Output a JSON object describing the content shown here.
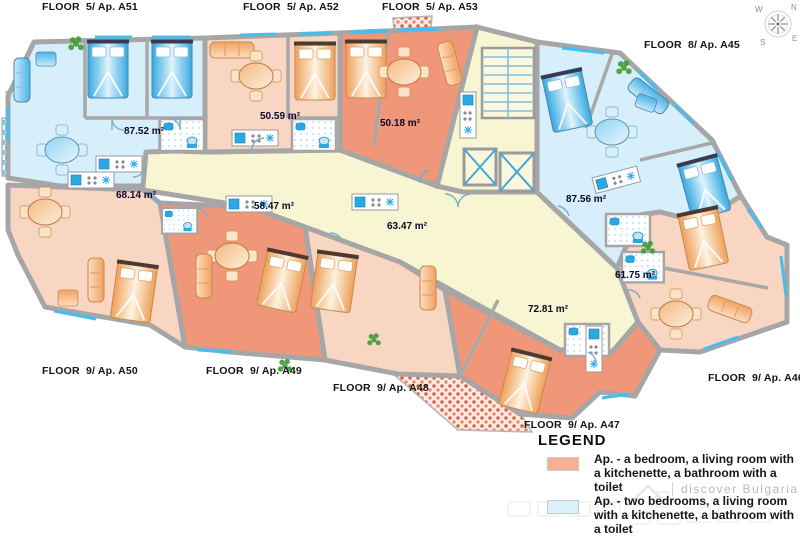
{
  "apartments": [
    {
      "name": "A51",
      "floor_label": "FLOOR  5/ Ap. A51",
      "area": "87.52 m²",
      "type": "two-bedroom"
    },
    {
      "name": "A52",
      "floor_label": "FLOOR  5/ Ap. A52",
      "area": "50.59 m²",
      "type": "one-bedroom"
    },
    {
      "name": "A53",
      "floor_label": "FLOOR  5/ Ap. A53",
      "area": "50.18 m²",
      "type": "one-bedroom"
    },
    {
      "name": "A45",
      "floor_label": "FLOOR  8/ Ap. A45",
      "area": "87.56 m²",
      "type": "two-bedroom"
    },
    {
      "name": "A50",
      "floor_label": "FLOOR  9/ Ap. A50",
      "area": "68.14 m²",
      "type": "one-bedroom"
    },
    {
      "name": "A49",
      "floor_label": "FLOOR  9/ Ap. A49",
      "area": "58.47 m²",
      "type": "one-bedroom"
    },
    {
      "name": "A48",
      "floor_label": "FLOOR  9/ Ap. A48",
      "area": "63.47 m²",
      "type": "one-bedroom"
    },
    {
      "name": "A47",
      "floor_label": "FLOOR  9/ Ap. A47",
      "area": "72.81 m²",
      "type": "one-bedroom"
    },
    {
      "name": "A46",
      "floor_label": "FLOOR  9/ Ap. A46",
      "area": "61.75 m²",
      "type": "one-bedroom"
    }
  ],
  "legend": {
    "title": "LEGEND",
    "items": [
      {
        "swatch_color": "#f6b094",
        "label": "Ap. - a bedroom, a living room with a kitchenette, a bathroom with a toilet"
      },
      {
        "swatch_color": "#d9f1fa",
        "label": "Ap. - two bedrooms, a living room with a kitchenette, a bathroom with a toilet"
      }
    ]
  },
  "compass": {
    "w": "W",
    "n": "N",
    "s": "S",
    "e": "E"
  },
  "watermark": "discover Bulgaria",
  "colors": {
    "one_bedroom_light": "#f8d6c2",
    "one_bedroom_dark": "#f0977a",
    "two_bedroom": "#d6effa",
    "corridor": "#f8f5d2",
    "wall": "#a6a6a6",
    "balcony_red": "#e05a3e",
    "balcony_blue": "#74c9ec"
  }
}
